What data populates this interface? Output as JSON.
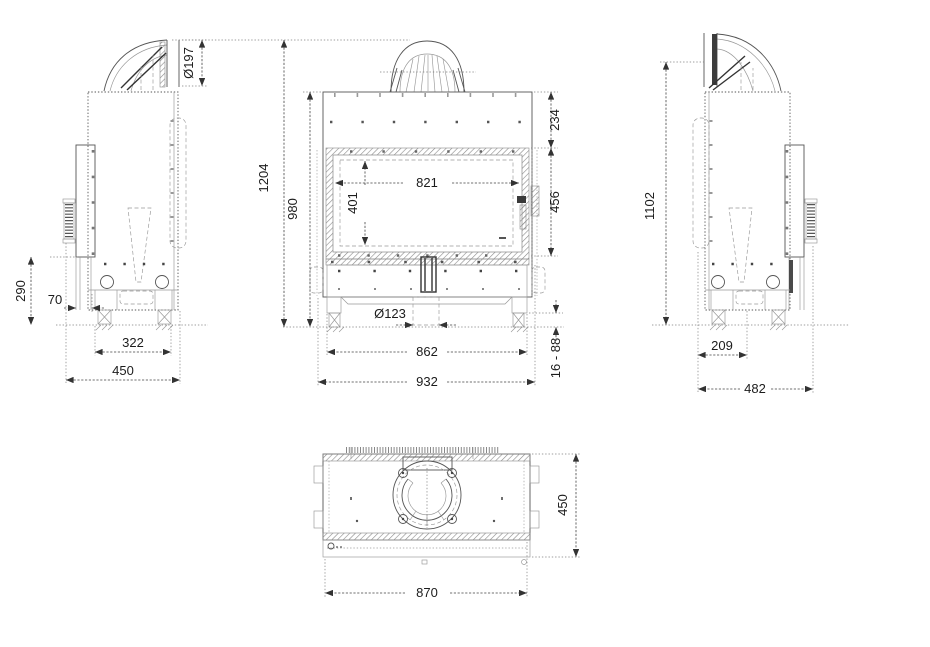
{
  "views": {
    "side_left": {
      "dimensions": {
        "flue_diameter": "Ø197",
        "rear_height": "290",
        "front_offset": "70",
        "feet_spacing": "322",
        "depth": "450"
      }
    },
    "front": {
      "dimensions": {
        "overall_height": "1204",
        "body_height": "980",
        "top_section": "234",
        "door_height": "456",
        "glass_width": "821",
        "glass_height": "401",
        "flue_outlet_diameter": "Ø123",
        "inner_width": "862",
        "overall_width": "932",
        "leg_range": "16 - 88"
      }
    },
    "side_right": {
      "dimensions": {
        "flue_height": "1102",
        "rear_offset": "209",
        "depth": "482"
      }
    },
    "top": {
      "dimensions": {
        "depth": "450",
        "width": "870"
      }
    }
  }
}
